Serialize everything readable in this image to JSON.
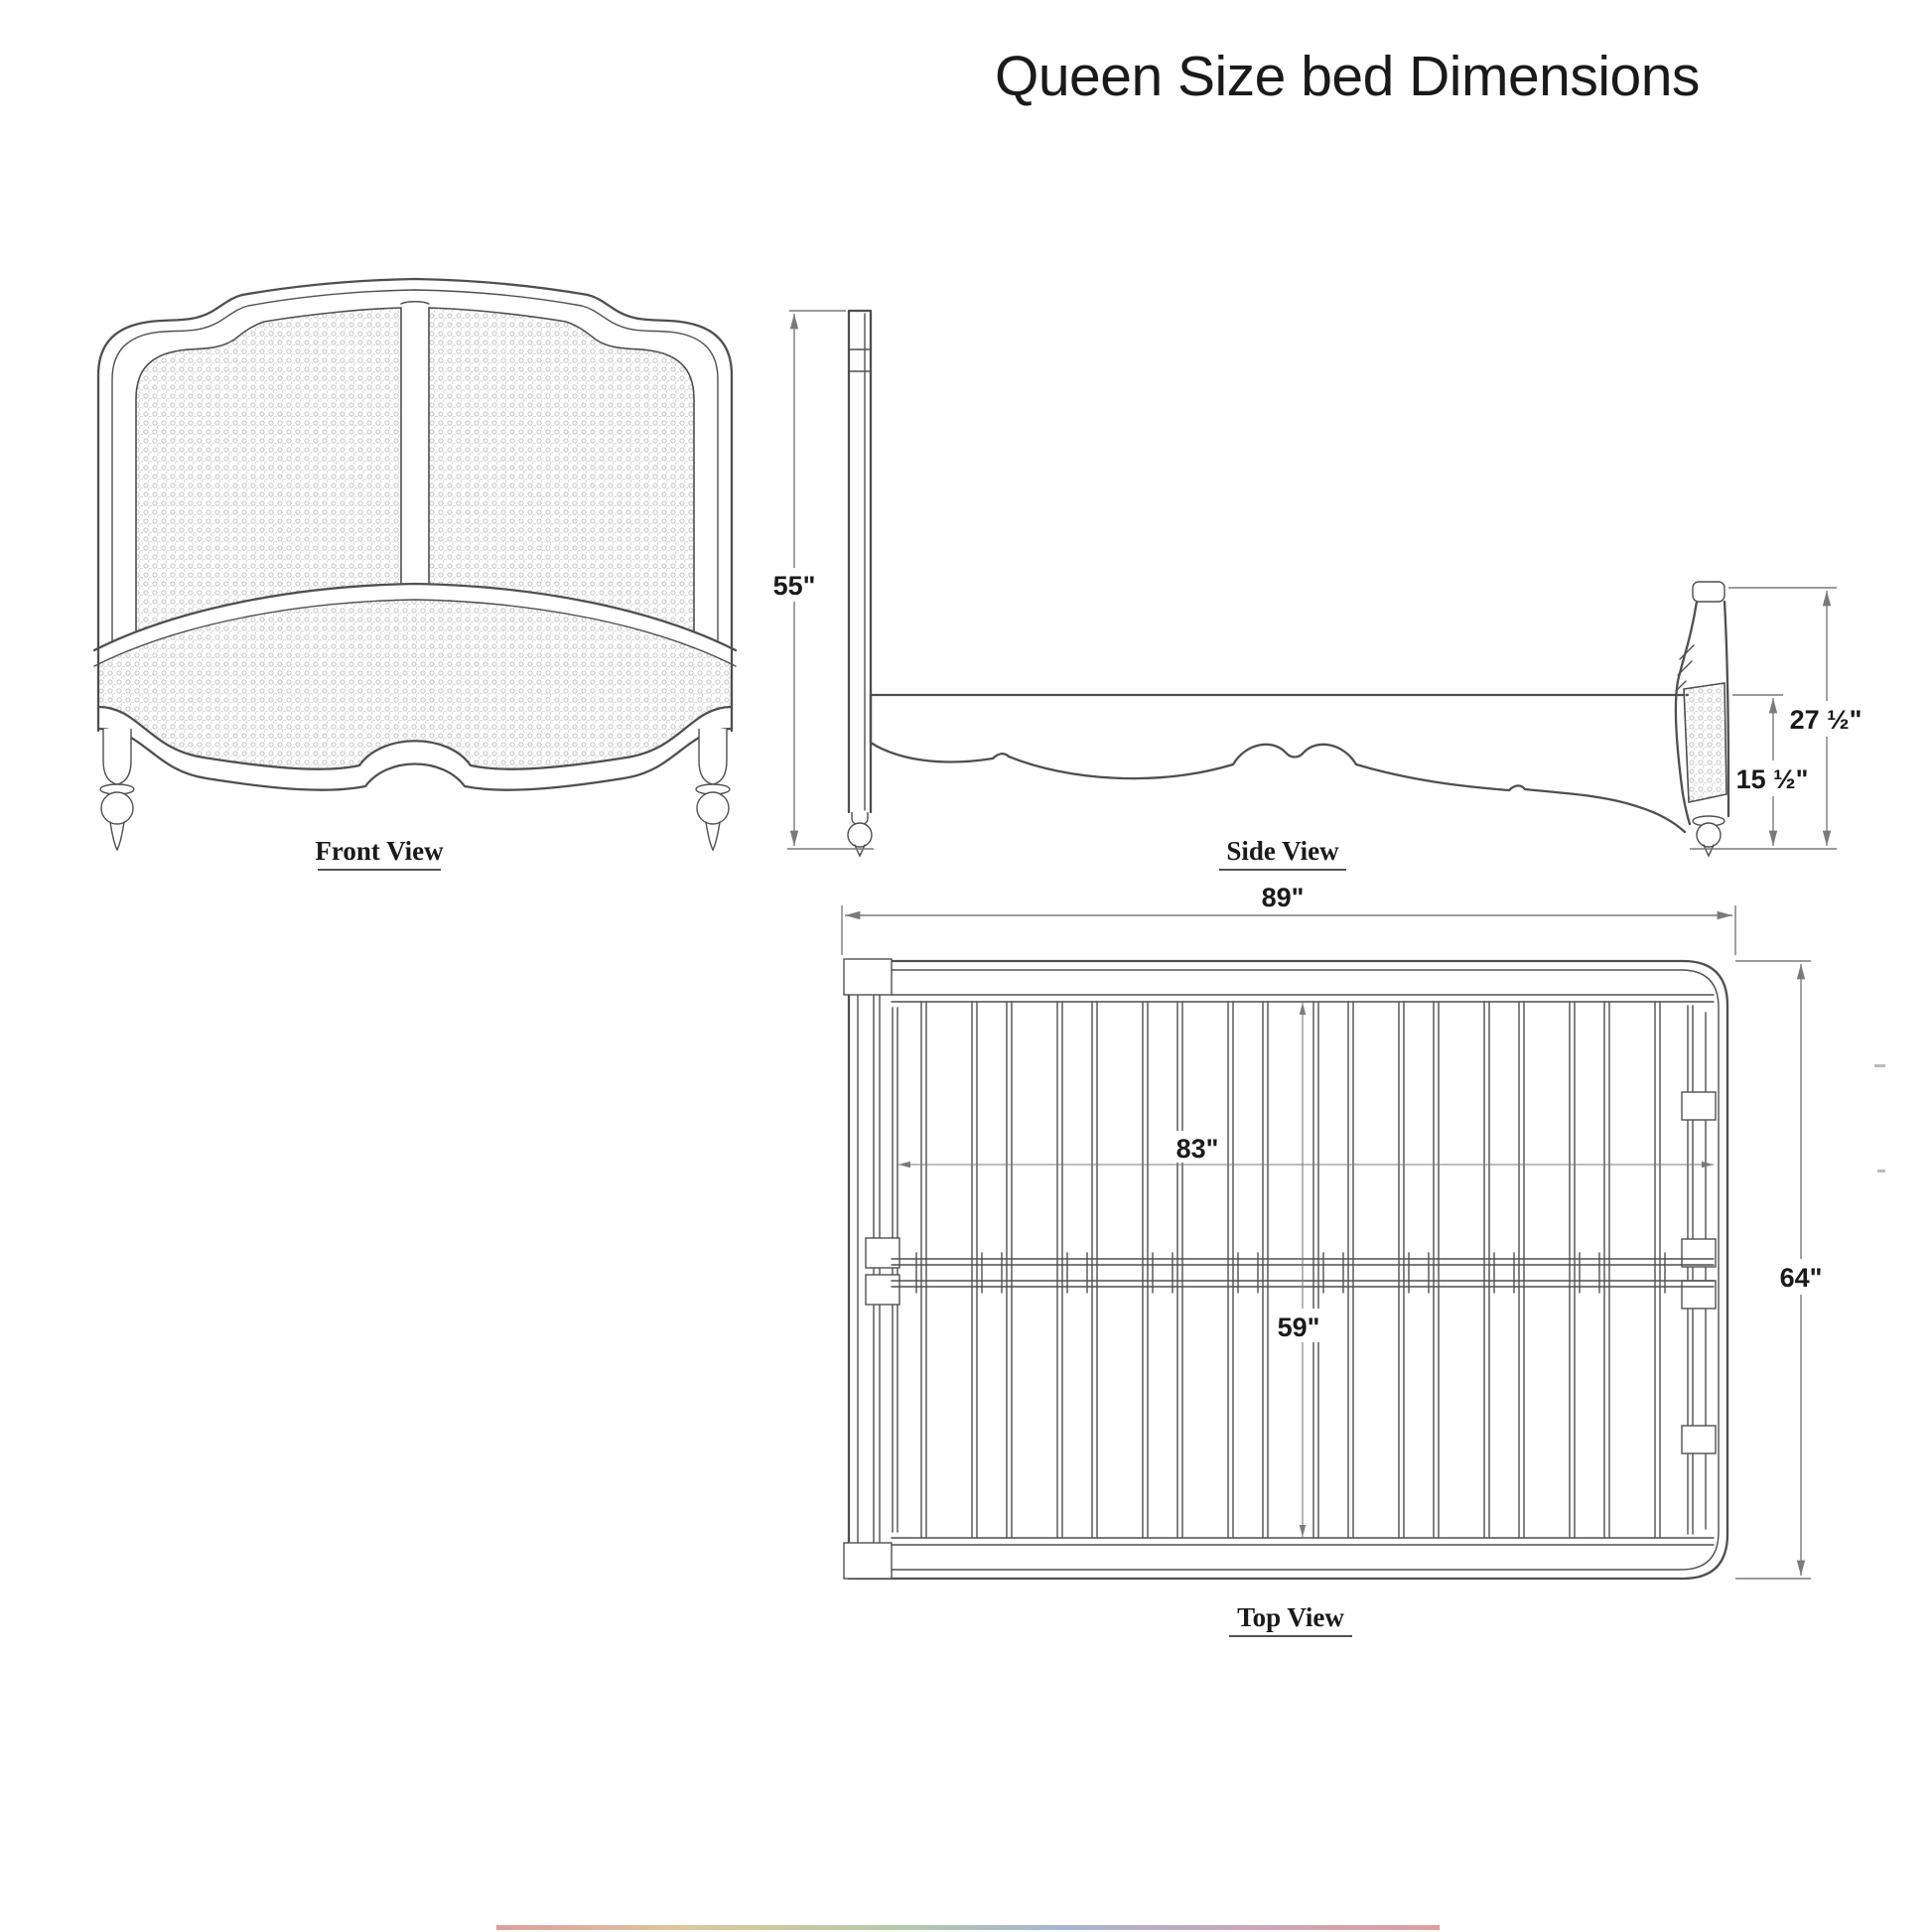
{
  "title": "Queen Size bed Dimensions",
  "views": {
    "front": {
      "label": "Front View"
    },
    "side": {
      "label": "Side View",
      "dimensions": {
        "headboard_height": "55\"",
        "footboard_height": "27 ½\"",
        "rail_height": "15 ½\""
      }
    },
    "top": {
      "label": "Top View",
      "dimensions": {
        "overall_length": "89\"",
        "interior_length": "83\"",
        "overall_width": "64\"",
        "interior_width": "59\""
      }
    }
  },
  "colors": {
    "ink": "#4f4f4f",
    "dimension": "#7a7a7a",
    "text": "#1a1a1a",
    "cane": "#c4c4c4",
    "background": "#ffffff"
  }
}
